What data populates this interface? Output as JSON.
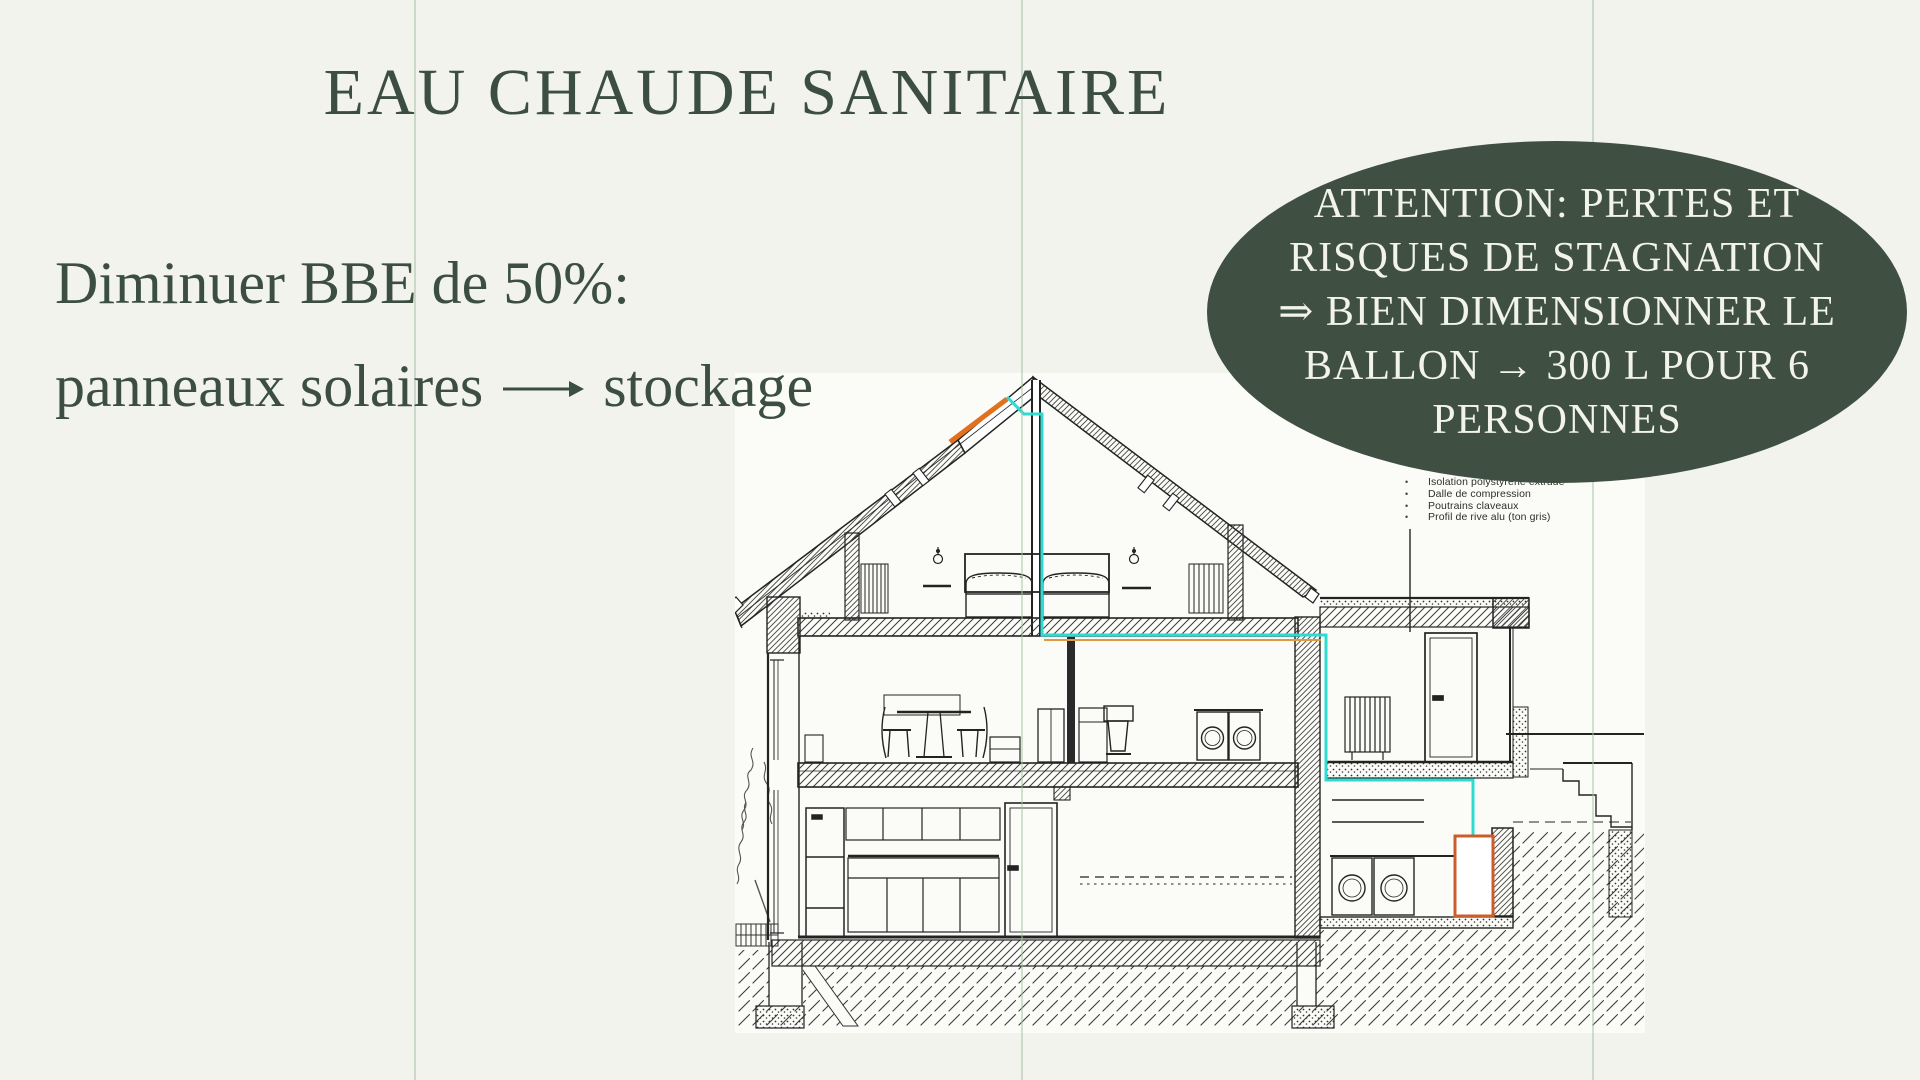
{
  "title": "EAU CHAUDE SANITAIRE",
  "body": {
    "line1": "Diminuer BBE de 50%:",
    "line2": {
      "before": "panneaux solaires",
      "arrow": "⟶",
      "after": "stockage"
    }
  },
  "callout": {
    "lines": [
      "ATTENTION: PERTES ET",
      "RISQUES DE STAGNATION",
      "⇒ BIEN DIMENSIONNER LE",
      "BALLON → 300 L POUR 6",
      "PERSONNES"
    ]
  },
  "drawing": {
    "annotations": [
      "Isolation polystyrène extrudé",
      "Dalle de compression",
      "Poutrains claveaux",
      "Profil de rive alu (ton gris)"
    ],
    "highlights": {
      "solar_panel": "orange segment on left roof slope",
      "hot_water_tank": "orange rectangle, ballon 300 L",
      "pipe_run": "teal line from roof to tank"
    }
  },
  "colors": {
    "background": "#f1f3ec",
    "panel": "#fbfcf8",
    "ink": "#3c4e41",
    "callout_bg": "#3f4f42",
    "callout_text": "#f2f3e9",
    "teal_pipe": "#2edbd2",
    "orange_pipe": "#e2711d",
    "tank_outline": "#cc5c2a",
    "guide_line": "#a9bfa4"
  }
}
